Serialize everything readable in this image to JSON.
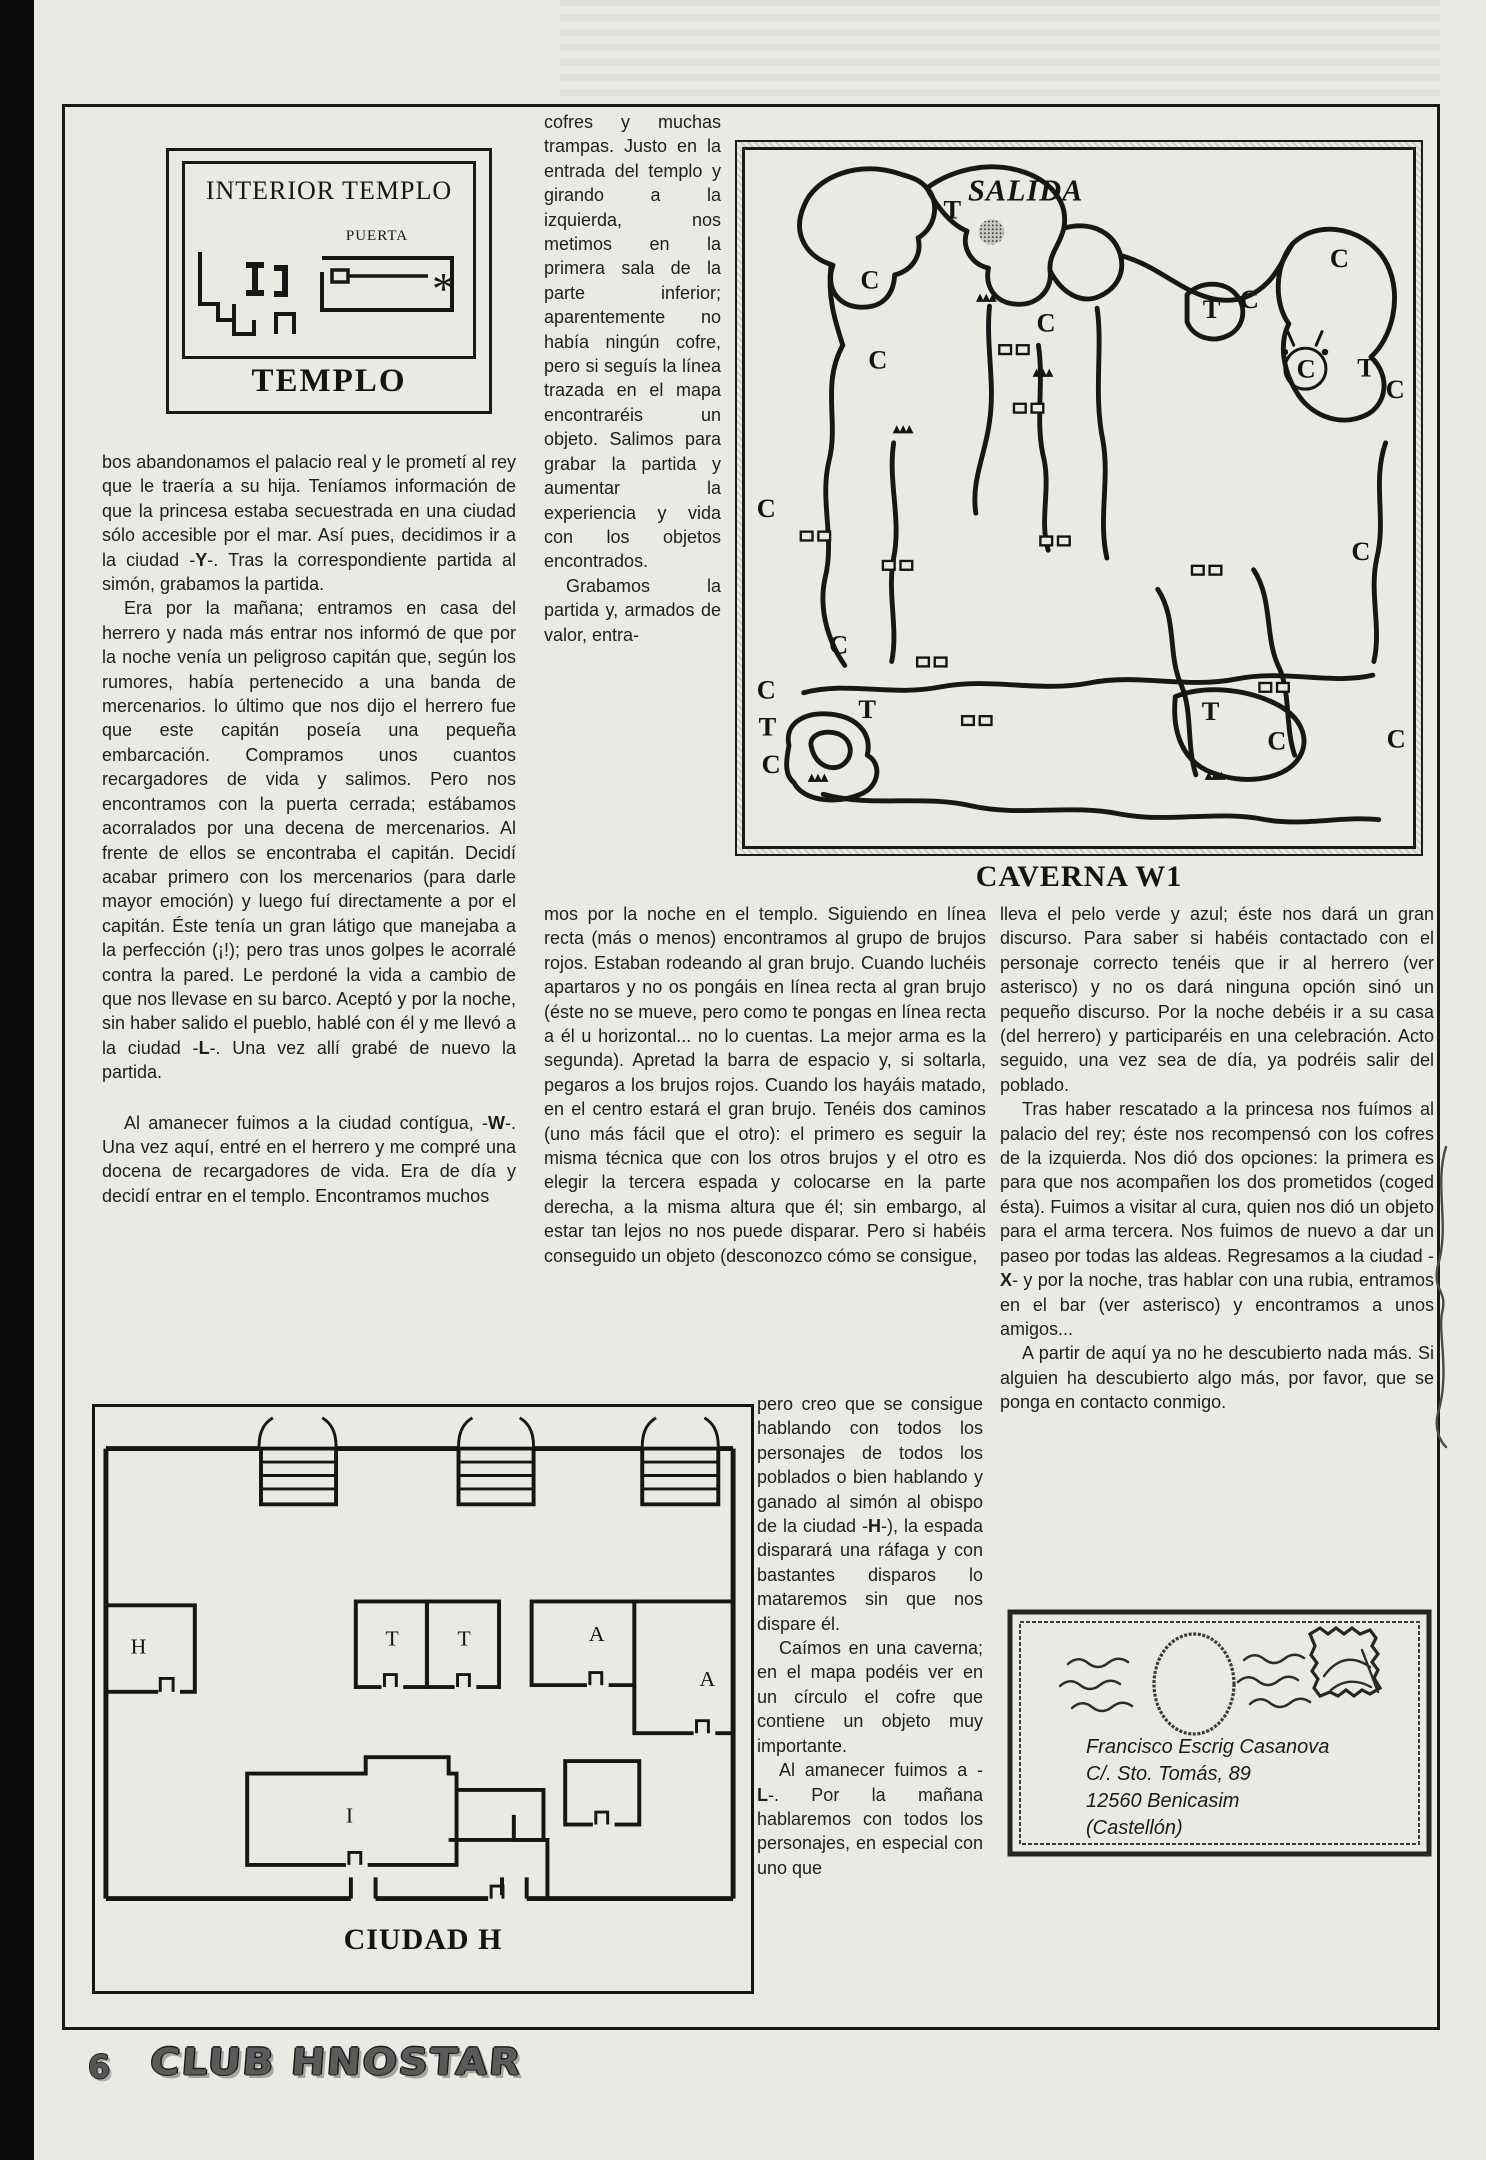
{
  "page": {
    "number": "6",
    "logo_text": "CLUB HNOSTAR"
  },
  "templo": {
    "title": "INTERIOR TEMPLO",
    "door_label": "PUERTA",
    "asterisk": "*",
    "caption": "TEMPLO"
  },
  "caverna": {
    "caption": "CAVERNA W1",
    "exit_label": "SALIDA",
    "triangle_marker": "▲▲▲",
    "chest": {
      "letter": "C",
      "x": 573,
      "y": 224
    },
    "letters": [
      {
        "t": "T",
        "x": 203,
        "y": 70
      },
      {
        "t": "C",
        "x": 118,
        "y": 142
      },
      {
        "t": "C",
        "x": 298,
        "y": 186
      },
      {
        "t": "C",
        "x": 126,
        "y": 224
      },
      {
        "t": "T",
        "x": 468,
        "y": 172
      },
      {
        "t": "C",
        "x": 506,
        "y": 162
      },
      {
        "t": "C",
        "x": 598,
        "y": 120
      },
      {
        "t": "T",
        "x": 626,
        "y": 232
      },
      {
        "t": "C",
        "x": 655,
        "y": 254
      },
      {
        "t": "C",
        "x": 620,
        "y": 420
      },
      {
        "t": "C",
        "x": 12,
        "y": 376
      },
      {
        "t": "C",
        "x": 86,
        "y": 516
      },
      {
        "t": "C",
        "x": 12,
        "y": 562
      },
      {
        "t": "T",
        "x": 14,
        "y": 600
      },
      {
        "t": "C",
        "x": 17,
        "y": 638
      },
      {
        "t": "T",
        "x": 116,
        "y": 582
      },
      {
        "t": "T",
        "x": 467,
        "y": 584
      },
      {
        "t": "C",
        "x": 534,
        "y": 614
      },
      {
        "t": "C",
        "x": 656,
        "y": 612
      }
    ],
    "triangles": [
      [
        236,
        154
      ],
      [
        294,
        231
      ],
      [
        151,
        289
      ],
      [
        64,
        646
      ],
      [
        470,
        644
      ]
    ],
    "doors": [
      [
        275,
        205
      ],
      [
        290,
        265
      ],
      [
        72,
        396
      ],
      [
        156,
        426
      ],
      [
        317,
        401
      ],
      [
        472,
        431
      ],
      [
        191,
        525
      ],
      [
        237,
        585
      ],
      [
        541,
        551
      ]
    ]
  },
  "ciudad": {
    "caption": "CIUDAD H",
    "rooms": [
      {
        "label": "H",
        "x": 30,
        "y": 250
      },
      {
        "label": "T",
        "x": 288,
        "y": 242
      },
      {
        "label": "T",
        "x": 361,
        "y": 242
      },
      {
        "label": "A",
        "x": 494,
        "y": 237
      },
      {
        "label": "A",
        "x": 606,
        "y": 284
      },
      {
        "label": "I",
        "x": 248,
        "y": 426
      }
    ]
  },
  "columns": {
    "left": [
      "bos abandonamos el palacio real y le prometí al rey  que le traería a su hija. Teníamos información de que la princesa estaba secuestrada en una ciudad sólo accesible por el mar. Así pues, decidimos ir a la ciudad -Y-. Tras la correspondiente partida al simón, grabamos la partida.",
      "Era por la mañana; entramos en casa del herrero y nada más entrar nos informó de que por la noche venía un peligroso capitán que, según los rumores, había pertenecido a una banda de mercenarios. lo último que nos dijo el herrero fue que este capitán poseía una pequeña embarcación. Compramos unos cuantos recargadores de vida y salimos. Pero nos encontramos con la puerta cerrada; estábamos acorralados por una decena de mercenarios. Al frente de ellos se encontraba el capitán. Decidí acabar primero con los mercenarios (para darle mayor emoción) y luego fuí directamente a por el capitán. Éste tenía un gran látigo que manejaba a la perfección (¡!); pero tras unos golpes le acorralé contra la pared. Le perdoné la vida a cambio de que nos llevase en su barco. Aceptó y por la noche, sin haber salido el pueblo, hablé con él y me llevó a la ciudad -L-. Una vez allí grabé de nuevo la partida.",
      "Al amanecer fuimos a la ciudad contígua, -W-. Una vez aquí, entré en el herrero y me compré una docena de recargadores de vida. Era de día y decidí entrar en el templo. Encontramos muchos"
    ],
    "mid_top": [
      "cofres y muchas trampas. Justo en la entrada del templo y girando a la izquierda, nos metimos en la primera sala de la parte inferior; aparentemente no había ningún cofre, pero si seguís la línea trazada en el mapa encontraréis un objeto. Salimos para grabar la partida y aumentar la experiencia y vida con los objetos encontrados.",
      "Grabamos la partida y, armados de valor, entra-"
    ],
    "mid_wide": [
      "mos por la noche en el templo. Siguiendo en línea recta (más o menos) encontramos al grupo de brujos rojos. Estaban rodeando al gran brujo. Cuando luchéis apartaros y no os pongáis en línea recta al gran brujo (éste no se mueve, pero como te pongas en línea recta a él u horizontal... no lo cuentas. La mejor arma es la segunda). Apretad la barra de espacio y, si soltarla, pegaros a los brujos rojos. Cuando los hayáis matado, en el centro estará el gran brujo. Tenéis dos caminos (uno más fácil que el otro): el primero es seguir la misma técnica que con los otros brujos y el otro es elegir la tercera espada y colocarse en la parte derecha, a la misma altura que él; sin embargo, al estar tan lejos no nos puede disparar. Pero si habéis conseguido un objeto (desconozco cómo se consigue,"
    ],
    "mid_lower": [
      "pero creo que se consigue hablando con todos los personajes de todos los poblados o bien hablando y ganado al simón al obispo de la ciudad -H-), la espada disparará una ráfaga y con bastantes disparos lo mataremos sin que nos dispare él.",
      "Caímos en una caverna; en el mapa podéis ver en un círculo el cofre que contiene un objeto muy importante.",
      "Al amanecer fuimos a -L-. Por la mañana hablaremos con todos los personajes, en especial con uno que"
    ],
    "right": [
      "lleva el pelo verde y azul; éste nos dará un gran discurso. Para saber si habéis contactado con el personaje correcto tenéis que ir al herrero (ver asterisco) y no os dará ninguna opción sinó un pequeño discurso. Por la noche debéis ir a su casa (del herrero) y participaréis en una celebración. Acto seguido, una vez sea de día, ya podréis salir del poblado.",
      "Tras haber rescatado a la princesa nos fuímos al palacio del rey; éste nos recompensó con los cofres de la izquierda. Nos dió dos opciones: la primera es para que nos acompañen los dos prometidos (coged ésta). Fuimos a visitar al cura, quien nos dió un objeto para el arma tercera. Nos fuimos de nuevo a dar un paseo por todas las aldeas. Regresamos a la ciudad -X- y por la noche, tras hablar con una rubia, entramos en el bar (ver asterisco) y encontramos a unos amigos...",
      "A partir de aquí ya no he descubierto nada más. Si alguien ha descubierto algo más, por favor, que se ponga en contacto conmigo."
    ]
  },
  "envelope": {
    "address_lines": [
      "Francisco Escrig Casanova",
      "C/. Sto. Tomás, 89",
      "12560 Benicasim",
      "(Castellón)"
    ]
  }
}
